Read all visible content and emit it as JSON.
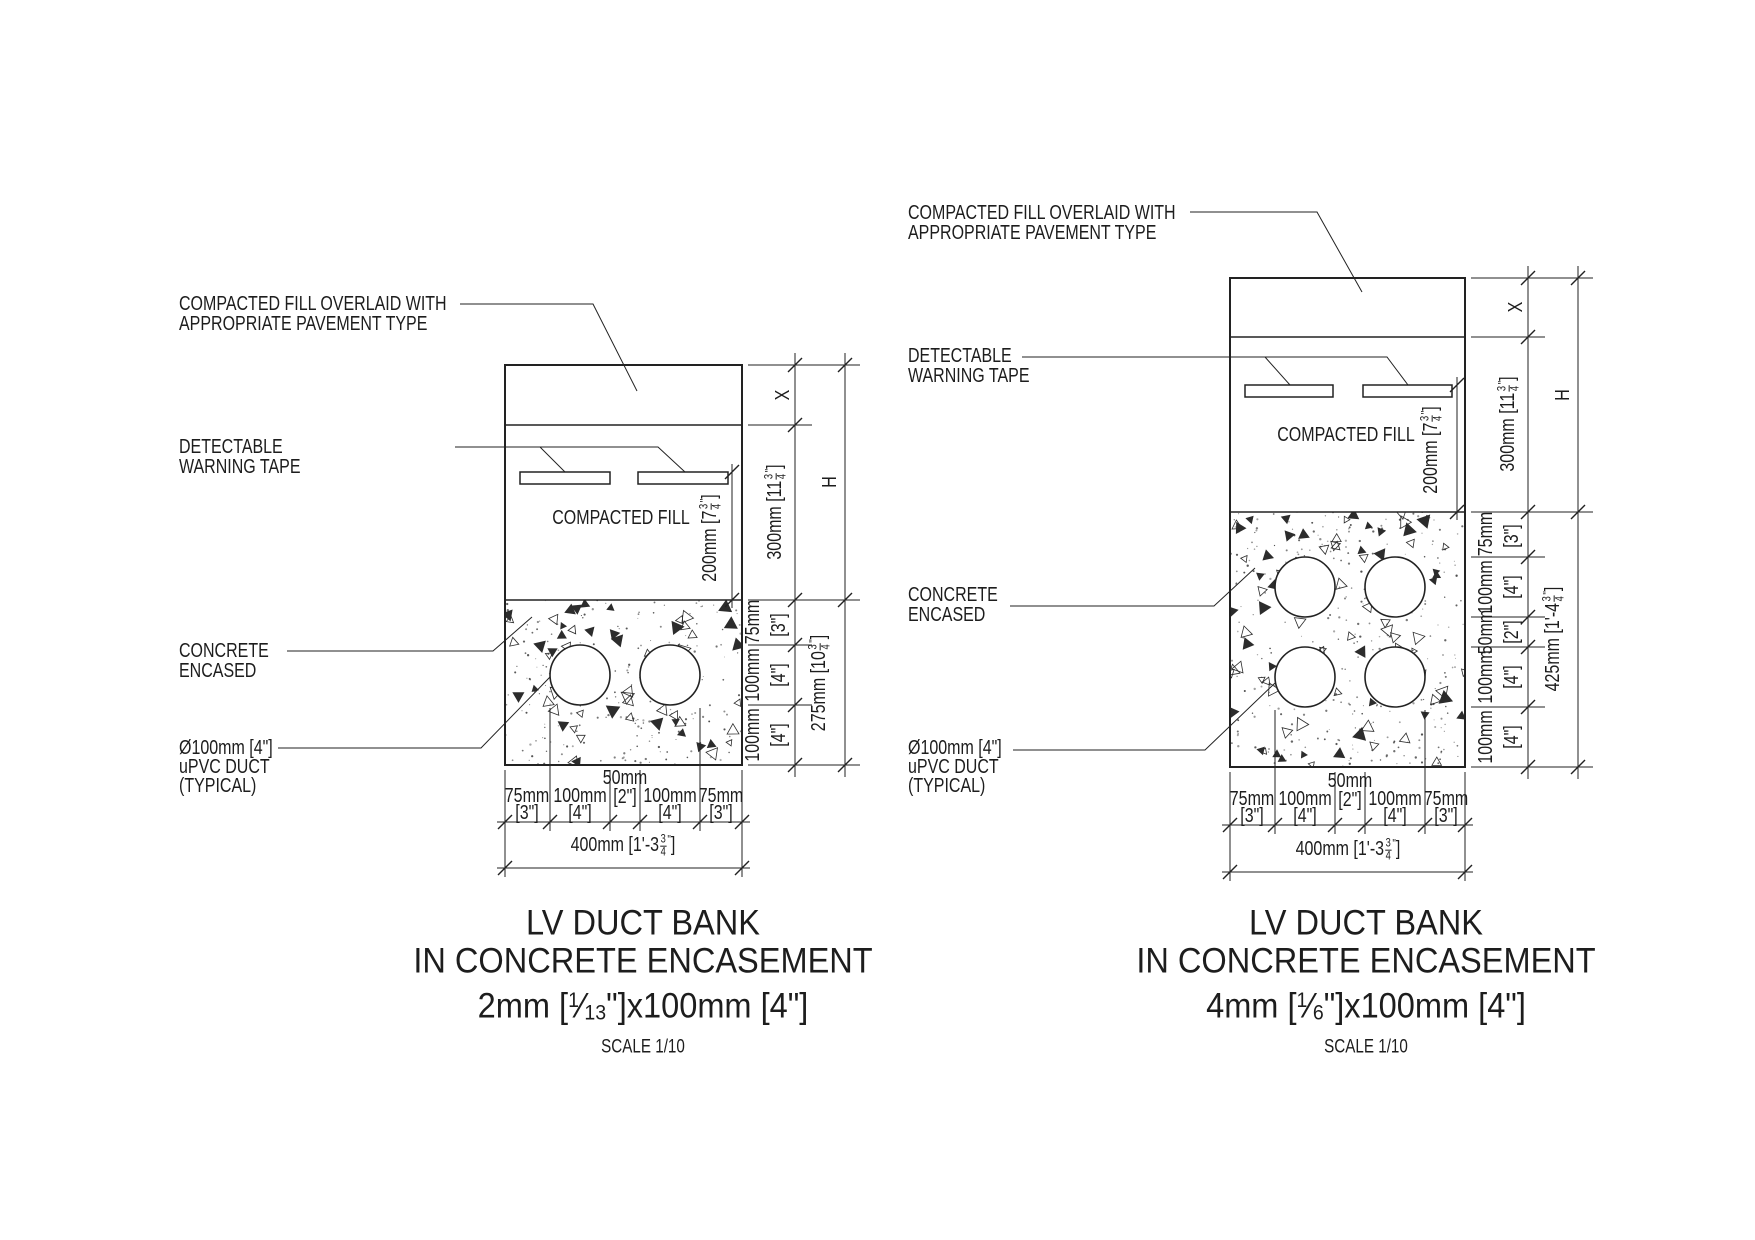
{
  "drawing": {
    "background": "#ffffff",
    "line_color": "#222222",
    "text_color": "#1d1d1d"
  },
  "diagrams": [
    {
      "id": "lv-duct-bank-2mm-2-ducts",
      "callouts": {
        "pavement": [
          "COMPACTED FILL OVERLAID WITH",
          "APPROPRIATE PAVEMENT TYPE"
        ],
        "warning_tape": [
          "DETECTABLE",
          "WARNING TAPE"
        ],
        "compacted_fill": "COMPACTED FILL",
        "concrete": [
          "CONCRETE",
          "ENCASED"
        ],
        "duct": [
          "Ø100mm [4\"]",
          "uPVC DUCT",
          "(TYPICAL)"
        ]
      },
      "dims": {
        "x": "X",
        "h": "H",
        "fill_depth": [
          {
            "t": "300mm [11"
          },
          {
            "frac": [
              "3",
              "4"
            ]
          },
          {
            "t": "\"",
            "sup": true
          },
          {
            "t": "]"
          }
        ],
        "tape_depth": [
          {
            "t": "200mm [7"
          },
          {
            "frac": [
              "3",
              "4"
            ]
          },
          {
            "t": "\"",
            "sup": true
          },
          {
            "t": "]"
          }
        ],
        "concrete_depth": [
          {
            "t": "275mm [10"
          },
          {
            "frac": [
              "3",
              "4"
            ]
          },
          {
            "t": "\"",
            "sup": true
          },
          {
            "t": "]"
          }
        ],
        "edge": "75mm",
        "edge_in": "[3\"]",
        "duct": "100mm",
        "duct_in": "[4\"]",
        "gap": "50mm",
        "gap_in": "[2\"]",
        "width": [
          {
            "t": "400mm [1'-3"
          },
          {
            "frac": [
              "3",
              "4"
            ]
          },
          {
            "t": "\"",
            "sup": true
          },
          {
            "t": "]"
          }
        ]
      },
      "title": {
        "line1": "LV DUCT BANK",
        "line2": "IN CONCRETE ENCASEMENT",
        "line3": [
          {
            "t": "2mm ["
          },
          {
            "dfrac": [
              "1",
              "13"
            ]
          },
          {
            "t": "\"]x100mm [4\"]"
          }
        ],
        "scale": "SCALE 1/10"
      }
    },
    {
      "id": "lv-duct-bank-4mm-4-ducts",
      "callouts": {
        "pavement": [
          "COMPACTED FILL OVERLAID WITH",
          "APPROPRIATE PAVEMENT TYPE"
        ],
        "warning_tape": [
          "DETECTABLE",
          "WARNING TAPE"
        ],
        "compacted_fill": "COMPACTED FILL",
        "concrete": [
          "CONCRETE",
          "ENCASED"
        ],
        "duct": [
          "Ø100mm [4\"]",
          "uPVC DUCT",
          "(TYPICAL)"
        ]
      },
      "dims": {
        "x": "X",
        "h": "H",
        "fill_depth": [
          {
            "t": "300mm [11"
          },
          {
            "frac": [
              "3",
              "4"
            ]
          },
          {
            "t": "\"",
            "sup": true
          },
          {
            "t": "]"
          }
        ],
        "tape_depth": [
          {
            "t": "200mm [7"
          },
          {
            "frac": [
              "3",
              "4"
            ]
          },
          {
            "t": "\"",
            "sup": true
          },
          {
            "t": "]"
          }
        ],
        "concrete_depth": [
          {
            "t": "425mm [1'-4"
          },
          {
            "frac": [
              "3",
              "4"
            ]
          },
          {
            "t": "\"",
            "sup": true
          },
          {
            "t": "]"
          }
        ],
        "edge": "75mm",
        "edge_in": "[3\"]",
        "duct": "100mm",
        "duct_in": "[4\"]",
        "gap": "50mm",
        "gap_in": "[2\"]",
        "width": [
          {
            "t": "400mm [1'-3"
          },
          {
            "frac": [
              "3",
              "4"
            ]
          },
          {
            "t": "\"",
            "sup": true
          },
          {
            "t": "]"
          }
        ]
      },
      "title": {
        "line1": "LV DUCT BANK",
        "line2": "IN CONCRETE ENCASEMENT",
        "line3": [
          {
            "t": "4mm ["
          },
          {
            "dfrac": [
              "1",
              "6"
            ]
          },
          {
            "t": "\"]x100mm [4\"]"
          }
        ],
        "scale": "SCALE 1/10"
      }
    }
  ]
}
